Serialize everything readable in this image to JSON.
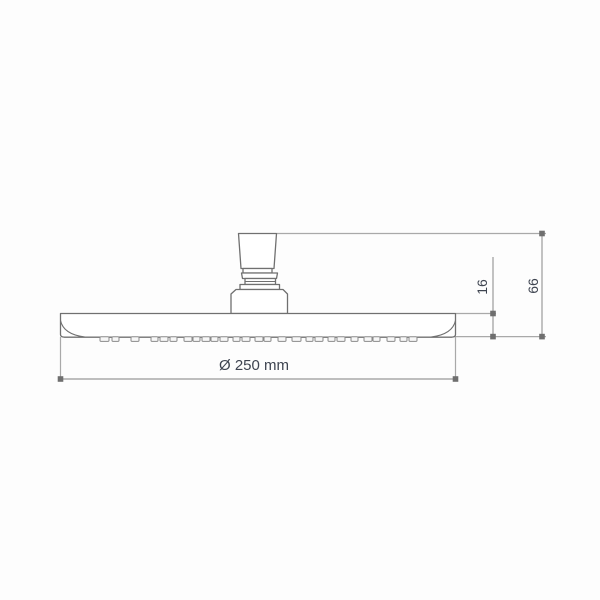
{
  "drawing": {
    "labels": {
      "diameter": "Ø 250 mm",
      "thickness": "16",
      "height": "66"
    },
    "colors": {
      "background": "#fdfdfd",
      "outline": "#707070",
      "dimension_line": "#a9a9a9",
      "marker": "#6f6f6f",
      "label_text": "#3e4450"
    }
  }
}
